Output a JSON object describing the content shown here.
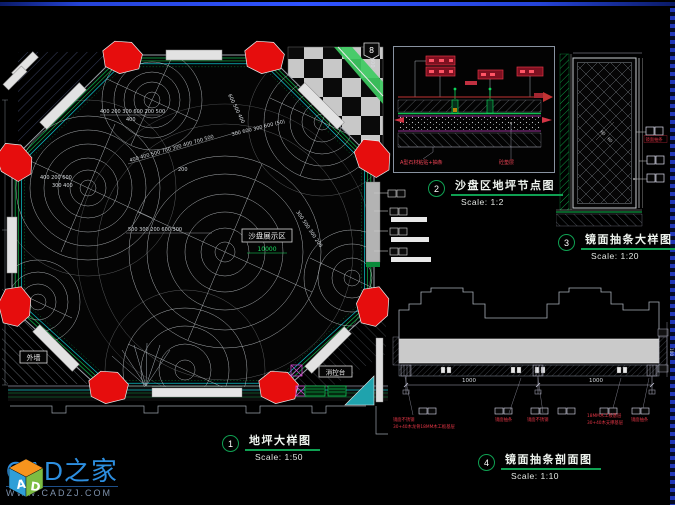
{
  "logo": {
    "brand": "CAD之家",
    "site": "WWW.CADZJ.COM",
    "cube_a": "A",
    "cube_d": "D"
  },
  "plan": {
    "badge": "8",
    "area_label": "沙盘展示区",
    "area_dim": "10000",
    "wall_label": "外墙",
    "console_label": "消控台",
    "title_no": "1",
    "title": "地坪大样图",
    "scale": "Scale: 1:50",
    "dims": [
      "400 200 300 600 200 500",
      "400",
      "400 400 500 700 300 400 700 500",
      "200",
      "500 300 200 600 300",
      "400 200 600",
      "300 400",
      "600 500 400",
      "300 600 300 600 (50)",
      "300 500 300 200",
      "600"
    ]
  },
  "detail2": {
    "title_no": "2",
    "title": "沙盘区地坪节点图",
    "scale": "Scale: 1:2",
    "label_left": "A型石材粘贴+抽条",
    "label_right": "砼垫层"
  },
  "detail3": {
    "title_no": "3",
    "title": "镜面抽条大样图",
    "scale": "Scale: 1:20",
    "red_label": "镜面抽条",
    "dim_a": "60",
    "dim_b": "60"
  },
  "detail4": {
    "title_no": "4",
    "title": "镜面抽条剖面图",
    "scale": "Scale: 1:10",
    "dim1": "1000",
    "dim2": "1000",
    "dim_side": "100",
    "labels": [
      "镜面不锈钢",
      "30+40木龙骨18MM木工板基层",
      "镜面抽条",
      "镜面不锈钢",
      "18MM木工板基层",
      "30+40木支撑基层",
      "镜面抽条"
    ]
  }
}
